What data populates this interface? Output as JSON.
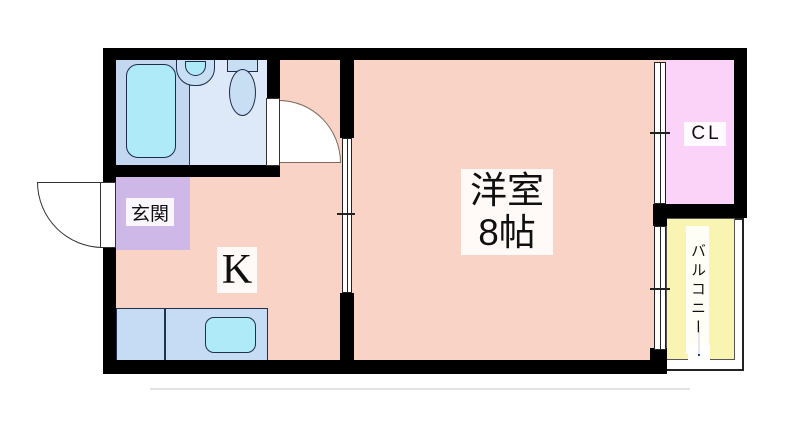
{
  "plan": {
    "type": "floor-plan",
    "rooms": {
      "main": {
        "name": "洋室",
        "size": "8帖",
        "color": "#f9d3c5"
      },
      "kitchen": {
        "label": "K",
        "color": "#f9d3c5"
      },
      "entrance": {
        "label": "玄関",
        "color": "#cdb8e8"
      },
      "closet": {
        "label": "CL",
        "color": "#fcd3f8"
      },
      "balcony": {
        "label": "バルコニー",
        "color": "#faf4b3"
      },
      "bathroom": {
        "bath_area_color": "#c3d8f0",
        "washroom_color": "#dde9f8"
      }
    },
    "fixtures": [
      "bathtub",
      "washbasin",
      "toilet",
      "kitchen-counter",
      "kitchen-sink"
    ],
    "openings": [
      "entrance-swing-door",
      "bathroom-swing-door",
      "sliding-door",
      "window-closet-side",
      "window-balcony-side"
    ],
    "colors": {
      "wall": "#000000",
      "water": "#aeeaf8",
      "fixture": "#c8def2",
      "counter": "#c5dcf4",
      "outline": "#1d2b4d"
    }
  }
}
